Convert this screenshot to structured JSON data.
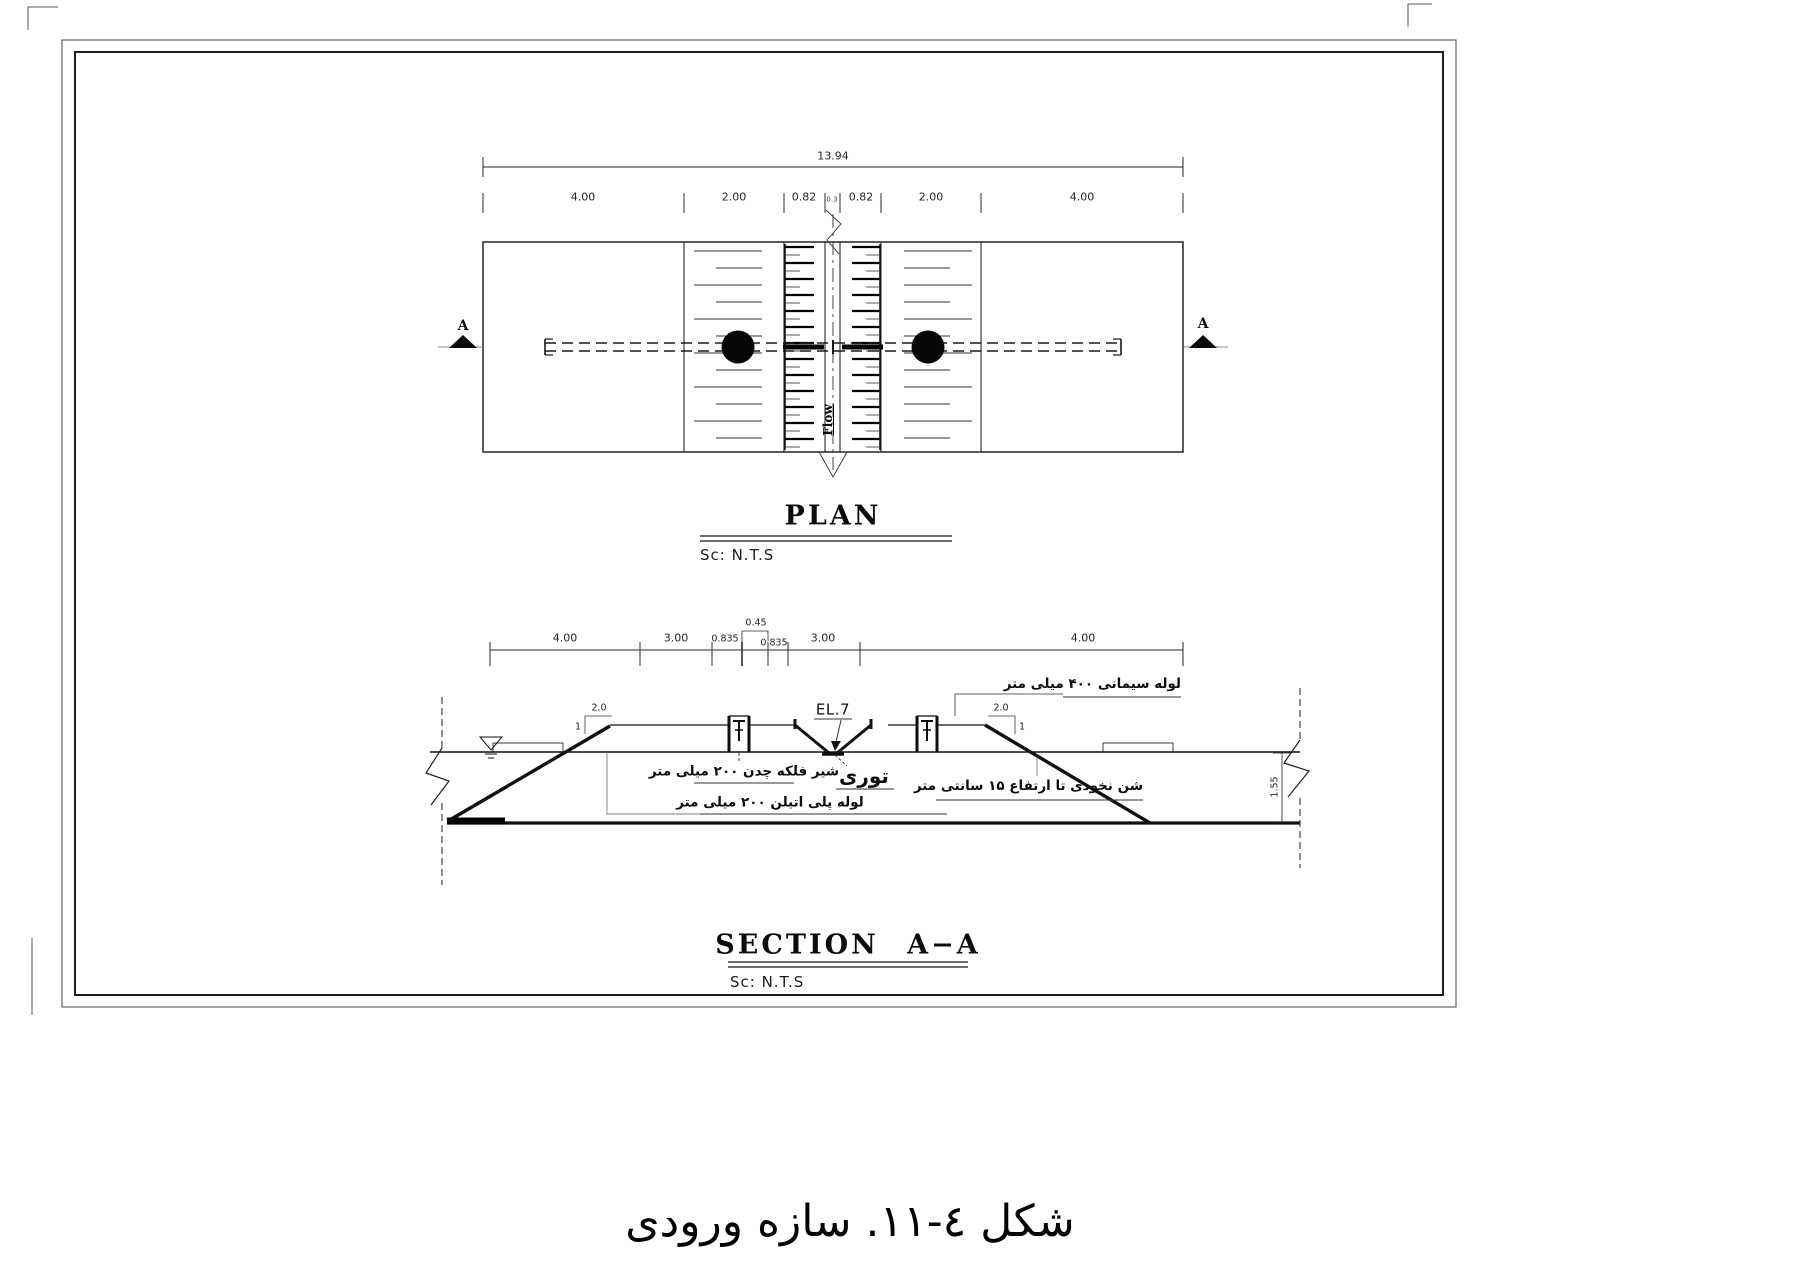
{
  "figure": {
    "caption": "شکل ٤-١١. سازه ورودی"
  },
  "plan": {
    "title": "PLAN",
    "scale_label": "Sc: N.T.S",
    "flow_label": "Flow",
    "section_marker": "A",
    "dims": {
      "total": "13.94",
      "segments": [
        "4.00",
        "2.00",
        "0.82",
        "0.3",
        "0.82",
        "2.00",
        "4.00"
      ]
    }
  },
  "section": {
    "title": "SECTION A−A",
    "scale_label": "Sc: N.T.S",
    "elevation_label": "EL.7",
    "dims": {
      "segments": [
        "4.00",
        "3.00",
        "0.835",
        "0.45",
        "0.835",
        "3.00",
        "4.00"
      ],
      "depth": "1.55",
      "slope_h": "2.0",
      "slope_v": "1"
    },
    "annotations": {
      "cement_pipe": "لوله سیمانی ۴۰۰ میلی متر",
      "gate_valve": "شیر فلکه چدن ۲۰۰ میلی متر",
      "screen": "توری",
      "pe_pipe": "لوله پلی اتیلن ۲۰۰ میلی متر",
      "gravel": "شن نخودی تا ارتفاع ۱۵ سانتی متر"
    }
  }
}
